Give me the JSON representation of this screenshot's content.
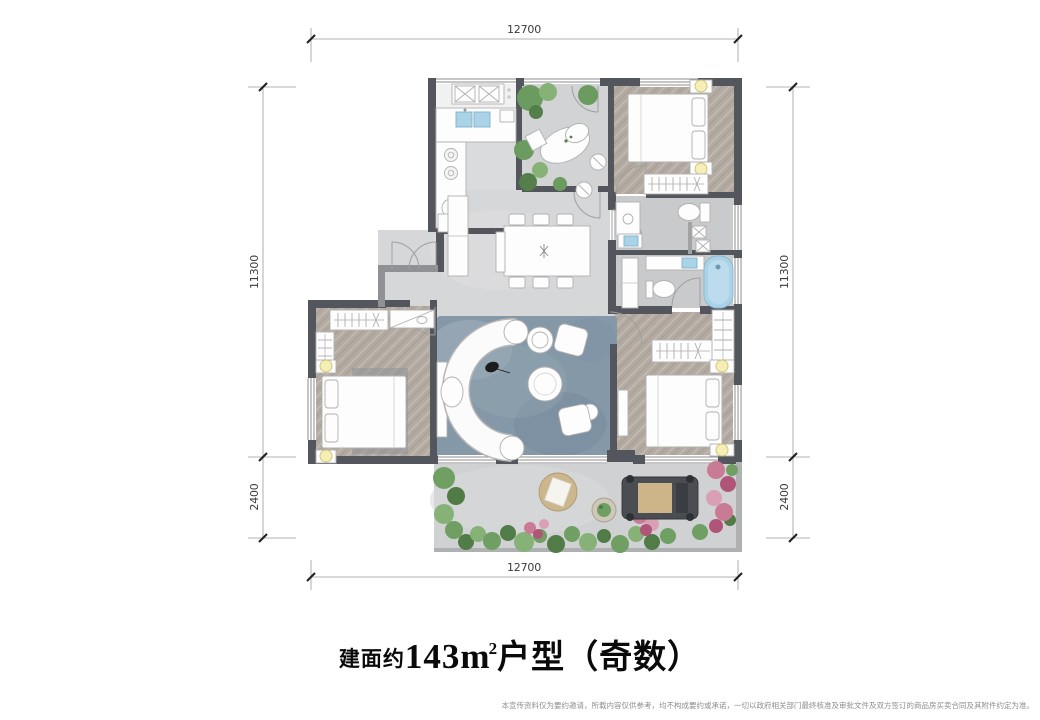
{
  "title": {
    "prefix": "建面约",
    "area_value": "143",
    "unit_base": "m",
    "unit_sup": "2",
    "suffix": "户型（奇数）"
  },
  "dimensions": {
    "top": "12700",
    "bottom": "12700",
    "left_upper": "11300",
    "left_lower": "2400",
    "right_upper": "11300",
    "right_lower": "2400"
  },
  "disclaimer": "本宣传资料仅为要约邀请，所载内容仅供参考，均不构成要约或承诺，一切以政府相关部门最终核准及审批文件及双方签订的商品房买卖合同及其附件约定为准。",
  "colors": {
    "wall": "#53575d",
    "wall_light": "#9b9da0",
    "floor_stone": "#d6d7d9",
    "floor_bath": "#c9cacc",
    "floor_wood": "#b3aba1",
    "rug_blue": "#8598a8",
    "fixture_blue": "#aad3e7",
    "plant_green": "#6f9f62",
    "flower_pink": "#c97b95",
    "lamp_yellow": "#f5eeb6",
    "dim_line": "#9a9a9a",
    "dim_text": "#3b3b3b"
  }
}
